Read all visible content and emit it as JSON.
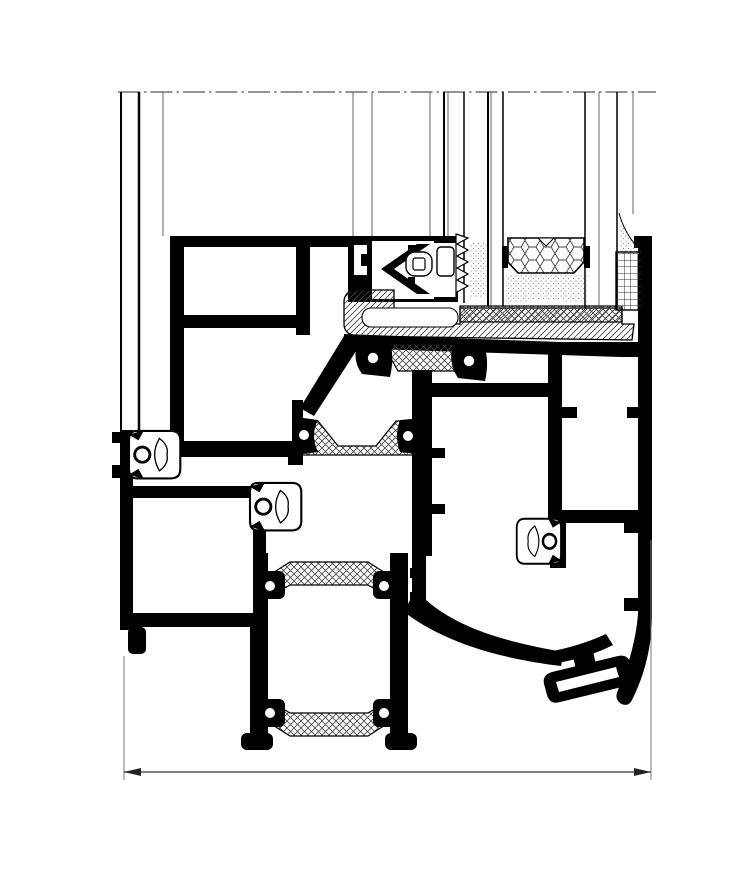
{
  "drawing": {
    "description": "Technical CAD cross-section detail of an aluminium window sill and curtain-wall node",
    "type": "aluminium-profile-section",
    "colors": {
      "background": "#ffffff",
      "profile": "#000000",
      "thin_line": "#666666",
      "hatch": "#444444",
      "stipple": "#8a8a8a",
      "dimension": "#333333"
    },
    "parts": [
      {
        "name": "cut-line",
        "desc": "dash-dot section cut line across the glazing"
      },
      {
        "name": "glass-panes",
        "desc": "thin vertical glazing pane lines"
      },
      {
        "name": "honeycomb-spacer",
        "desc": "hexagonal foam spacer block of the insulating glass unit"
      },
      {
        "name": "setting-block",
        "desc": "cross-hatched glazing setting block"
      },
      {
        "name": "glazing-bridge",
        "desc": "diagonally hatched glazing bridge profile"
      },
      {
        "name": "chevron-gasket",
        "desc": "chevron glazing gasket with clip"
      },
      {
        "name": "serrated-gasket",
        "desc": "serrated gasket strip"
      },
      {
        "name": "thermal-breaks",
        "desc": "cross-hatched polyamide thermal break bars"
      },
      {
        "name": "bubble-gaskets",
        "desc": "EPDM bubble gaskets with ring holes"
      },
      {
        "name": "frame-profiles",
        "desc": "black aluminium frame chamber profiles"
      },
      {
        "name": "mullion-profile",
        "desc": "lower mullion profile with twin thermal breaks"
      },
      {
        "name": "drainage-clip",
        "desc": "angled drainage clip detail at bottom right"
      },
      {
        "name": "grid-seal",
        "desc": "grid-hatched seal block at right jamb"
      },
      {
        "name": "dimension-line",
        "desc": "overall width dimension line with arrowheads"
      }
    ],
    "dimension": {
      "label": ""
    }
  }
}
